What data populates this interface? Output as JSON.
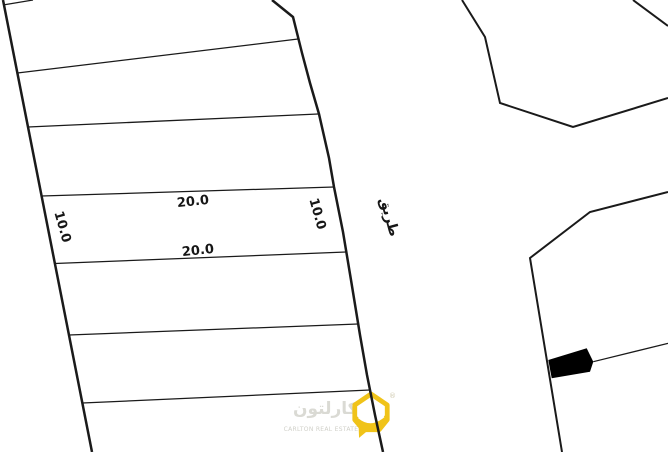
{
  "page": {
    "background": "#ffffff",
    "line_color": "#1a1a1a"
  },
  "map": {
    "plot_labels": {
      "top_width": "20.0",
      "bottom_width": "20.0",
      "left_depth": "10.0",
      "right_depth": "10.0"
    },
    "road_label": "طريق"
  },
  "watermark": {
    "brand_arabic": "كارلتون",
    "brand_english": "CARLTON REAL ESTATE",
    "registered_mark": "®",
    "brand_color": "#f0c319",
    "text_color": "#dadad4"
  }
}
